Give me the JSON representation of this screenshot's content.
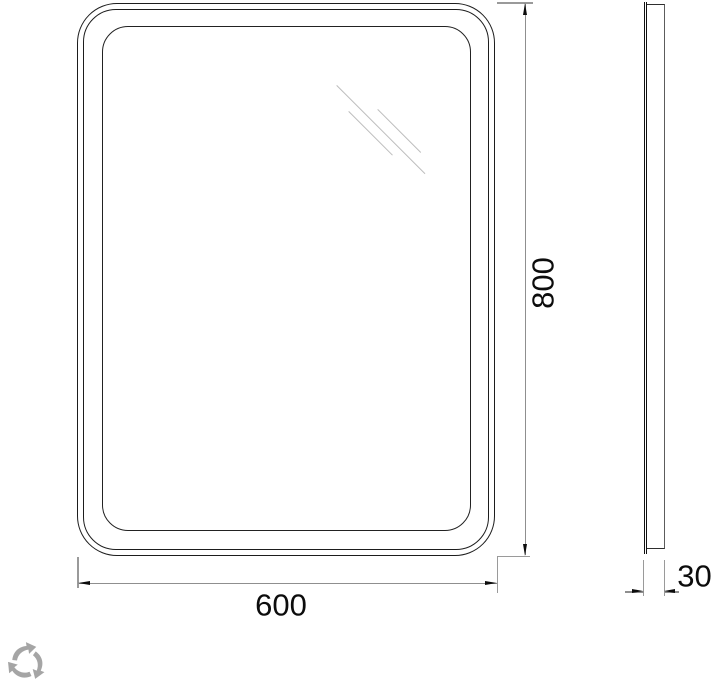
{
  "page": {
    "description": "Technical dimension drawing of a rectangular mirror with rounded corners: front view and side profile view",
    "background": "#ffffff"
  },
  "front_view": {
    "name": "mirror front view",
    "frame_line_count": 3,
    "shine_line_count": 3
  },
  "side_view": {
    "name": "mirror side profile view"
  },
  "dimensions": {
    "height": {
      "label": "800",
      "orientation": "vertical"
    },
    "width": {
      "label": "600",
      "orientation": "horizontal"
    },
    "depth": {
      "label": "30",
      "orientation": "horizontal"
    }
  },
  "colors": {
    "outline": "#1d1d1d",
    "dimension_line": "#8f8f8f",
    "text": "#0c0c0c",
    "shine": "#bdbdbd",
    "logo": "#a5a5a5"
  },
  "logo": {
    "name": "recycle-arrows-logo"
  }
}
